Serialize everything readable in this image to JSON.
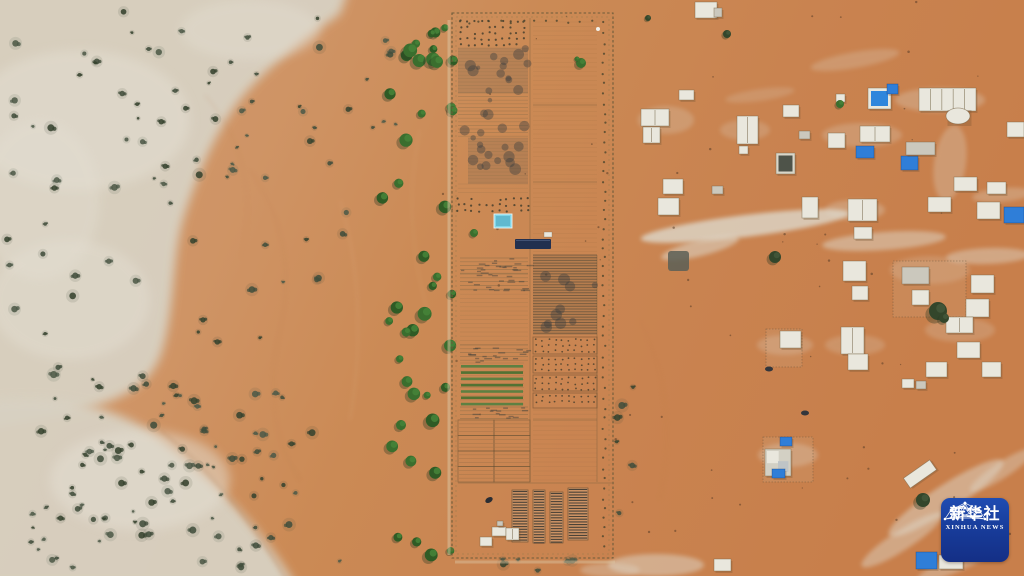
{
  "meta": {
    "description": "Aerial drone photograph of a desert landscape: a long fenced agricultural plot with cultivated fields in the center, pale sandy scrubland with scattered bushes on the left, a line of green trees beside the farm, and a scattered desert village of small white and blue-roofed buildings on orange sand to the right. A Xinhua News agency logo badge sits in the lower right corner."
  },
  "logo": {
    "cn": "新华社",
    "en": "XINHUA NEWS"
  },
  "palette": {
    "sand_left": "#d09a6e",
    "sand_mid": "#cb8a55",
    "sand_right": "#c87f4b",
    "sand_pale": "#d8d1c2",
    "sand_pale_light": "#e4dfd3",
    "sand_pale_green": "#cfd2bd",
    "scrub_green": "#4e5a48",
    "scrub_dark": "#37432f",
    "tree_green": "#3a6e2e",
    "tree_green_light": "#468238",
    "tree_shadow": "#2a3a22",
    "water_cyan": "#7fd6e9",
    "shade_navy": "#22304f",
    "building_white": "#e9e7dd",
    "building_gray": "#cbc8bd",
    "tarp_blue": "#2f7ed8",
    "dark_structure": "#5a5f56",
    "track_white": "#ded8ca",
    "fence_brown": "#6d5c3b",
    "logo_blue_top": "#1f4cb2",
    "logo_blue_bottom": "#142f86"
  },
  "scene": {
    "pale_areas": [
      {
        "d": "M -20 -20 L 352 -20 L 340 14 C 300 42 258 74 234 108 C 212 140 196 178 183 220 C 172 258 175 306 163 348 C 152 388 118 402 60 416 L -20 430 Z",
        "o": 0.95
      },
      {
        "d": "M -20 402 C 50 392 112 402 162 440 C 210 476 258 524 296 586 L -20 586 Z",
        "o": 0.95
      }
    ],
    "pale_patches": [
      [
        80,
        120,
        110,
        70,
        0.5
      ],
      [
        70,
        300,
        80,
        60,
        0.45
      ],
      [
        140,
        480,
        90,
        50,
        0.5
      ],
      [
        250,
        30,
        70,
        30,
        0.4
      ],
      [
        40,
        200,
        60,
        80,
        0.4
      ]
    ],
    "streaks": [
      [
        745,
        226,
        105,
        11,
        -7,
        0.8
      ],
      [
        700,
        248,
        40,
        8,
        -14,
        0.55
      ],
      [
        884,
        241,
        62,
        9,
        -4,
        0.5
      ],
      [
        950,
        163,
        16,
        38,
        8,
        0.3
      ],
      [
        988,
        256,
        42,
        8,
        -2,
        0.45
      ],
      [
        1002,
        195,
        30,
        7,
        -5,
        0.3
      ],
      [
        946,
        498,
        68,
        13,
        -33,
        0.5
      ],
      [
        902,
        540,
        48,
        10,
        -33,
        0.45
      ],
      [
        1002,
        470,
        38,
        8,
        -33,
        0.4
      ],
      [
        962,
        560,
        50,
        9,
        -25,
        0.4
      ],
      [
        656,
        565,
        48,
        11,
        0,
        0.5
      ],
      [
        610,
        570,
        30,
        7,
        0,
        0.35
      ],
      [
        855,
        60,
        45,
        8,
        -10,
        0.25
      ],
      [
        760,
        95,
        35,
        6,
        -8,
        0.2
      ],
      [
        666,
        120,
        28,
        14,
        0,
        0.25
      ],
      [
        745,
        130,
        25,
        10,
        0,
        0.22
      ],
      [
        862,
        135,
        40,
        12,
        0,
        0.25
      ],
      [
        940,
        100,
        45,
        12,
        0,
        0.3
      ],
      [
        855,
        210,
        30,
        10,
        0,
        0.3
      ],
      [
        960,
        330,
        35,
        12,
        0,
        0.22
      ],
      [
        855,
        345,
        30,
        10,
        0,
        0.22
      ],
      [
        785,
        345,
        28,
        10,
        0,
        0.25
      ],
      [
        788,
        455,
        30,
        12,
        0,
        0.3
      ],
      [
        930,
        270,
        40,
        14,
        0,
        0.2
      ]
    ],
    "dune_lines": [
      {
        "d": "M 160 430 C 210 470 252 520 290 586",
        "c": "#a4693c",
        "o": 0.3,
        "w": 2
      },
      {
        "d": "M 250 170 Q 300 240 280 330 T 300 480",
        "c": "#b5784a",
        "o": 0.2,
        "w": 1.5
      },
      {
        "d": "M 205 95 Q 262 160 242 258",
        "c": "#b5784a",
        "o": 0.18,
        "w": 1.3
      },
      {
        "d": "M 340 200 Q 370 300 350 420",
        "c": "#e2b489",
        "o": 0.3,
        "w": 1.3
      },
      {
        "d": "M 420 130 Q 400 220 430 320",
        "c": "#e2b489",
        "o": 0.25,
        "w": 1.2
      },
      {
        "d": "M 640 320 Q 680 400 660 500",
        "c": "#c07b49",
        "o": 0.15,
        "w": 2
      }
    ],
    "vegetation_regions": [
      [
        5,
        8,
        330,
        165,
        42,
        "scrub",
        11
      ],
      [
        0,
        170,
        175,
        230,
        26,
        "scrub",
        23
      ],
      [
        8,
        392,
        295,
        178,
        52,
        "scrub",
        37
      ],
      [
        60,
        415,
        200,
        120,
        30,
        "scrub",
        41
      ],
      [
        185,
        140,
        165,
        430,
        24,
        "scrub",
        53
      ],
      [
        330,
        20,
        70,
        110,
        8,
        "scrub",
        61
      ],
      [
        382,
        55,
        72,
        515,
        34,
        "tree",
        71
      ],
      [
        390,
        15,
        62,
        50,
        9,
        "tree",
        83
      ],
      [
        470,
        558,
        120,
        16,
        6,
        "scrub",
        97
      ],
      [
        615,
        300,
        25,
        240,
        6,
        "scrub",
        101
      ],
      [
        620,
        0,
        400,
        540,
        45,
        "speck",
        103
      ],
      [
        440,
        0,
        180,
        570,
        20,
        "speck",
        109
      ]
    ],
    "village_trees": [
      [
        775,
        257,
        6,
        "dark"
      ],
      [
        938,
        311,
        9,
        "dark"
      ],
      [
        944,
        318,
        5,
        "dark"
      ],
      [
        840,
        104,
        4,
        "green"
      ],
      [
        727,
        34,
        4,
        "dark"
      ],
      [
        923,
        500,
        7,
        "dark"
      ],
      [
        648,
        18,
        3,
        "dark"
      ],
      [
        581,
        63,
        5,
        "green"
      ],
      [
        577,
        59,
        2.5,
        "green"
      ],
      [
        474,
        233,
        4,
        "green"
      ]
    ],
    "farm": {
      "fence_outer": [
        452,
        13,
        161,
        545
      ],
      "fence_inner": [
        456,
        17,
        153,
        537
      ],
      "lanes": [
        [
          530,
          18,
          530,
          482
        ],
        [
          458,
          483,
          612,
          483
        ],
        [
          533,
          420,
          597,
          420
        ],
        [
          597,
          255,
          597,
          482
        ],
        [
          533,
          105,
          597,
          105
        ],
        [
          533,
          182,
          597,
          182
        ]
      ],
      "track_left": [
        449,
        20,
        449,
        555
      ],
      "track_bottom": [
        455,
        562,
        615,
        562
      ],
      "blocks": [
        [
          458,
          18,
          70,
          30,
          "orchard"
        ],
        [
          458,
          48,
          70,
          45,
          "darkpatch"
        ],
        [
          458,
          93,
          70,
          45,
          "rowspeckle"
        ],
        [
          468,
          138,
          60,
          46,
          "darkpatch"
        ],
        [
          458,
          184,
          70,
          12,
          "rowsfaint"
        ],
        [
          455,
          196,
          80,
          18,
          "orchard"
        ],
        [
          460,
          258,
          68,
          16,
          "rows"
        ],
        [
          460,
          274,
          68,
          16,
          "rows"
        ],
        [
          460,
          290,
          68,
          55,
          "rowsfaint"
        ],
        [
          460,
          345,
          68,
          17,
          "rows"
        ],
        [
          460,
          363,
          64,
          44,
          "greenrows"
        ],
        [
          460,
          407,
          68,
          13,
          "rows"
        ],
        [
          458,
          420,
          72,
          62,
          "grid"
        ],
        [
          533,
          20,
          64,
          85,
          "furrows"
        ],
        [
          533,
          105,
          64,
          75,
          "furrows"
        ],
        [
          533,
          182,
          64,
          70,
          "furrows"
        ],
        [
          533,
          255,
          64,
          80,
          "rowsdark"
        ],
        [
          533,
          337,
          64,
          17,
          "dots"
        ],
        [
          533,
          356,
          64,
          17,
          "dots"
        ],
        [
          533,
          375,
          64,
          16,
          "dots"
        ],
        [
          533,
          393,
          64,
          15,
          "dots"
        ],
        [
          533,
          410,
          64,
          12,
          "rowsfaint"
        ],
        [
          533,
          424,
          64,
          58,
          "furrows"
        ]
      ],
      "nursery_beds": [
        [
          512,
          490,
          16,
          52
        ],
        [
          533,
          490,
          12,
          53
        ],
        [
          550,
          492,
          13,
          51
        ],
        [
          568,
          488,
          20,
          52
        ]
      ],
      "pond": [
        494,
        214,
        18,
        14
      ],
      "shade_structure": [
        515,
        239,
        36,
        10
      ],
      "white_hut": [
        544,
        232,
        8,
        5
      ],
      "white_dot": [
        598,
        29
      ],
      "car": [
        489,
        500
      ],
      "buildings": [
        [
          492,
          527,
          14,
          9,
          "w"
        ],
        [
          506,
          528,
          13,
          12,
          "w2"
        ],
        [
          480,
          537,
          12,
          9,
          "w"
        ],
        [
          497,
          521,
          6,
          5,
          "g"
        ]
      ],
      "fence_dot_cols": [
        [
          604,
          22,
          548
        ]
      ],
      "fence_dot_rows": [
        [
          22,
          460,
          600
        ]
      ]
    },
    "village": {
      "compound_fences": [
        [
          893,
          261,
          73,
          56
        ],
        [
          766,
          329,
          36,
          38
        ],
        [
          763,
          437,
          50,
          45
        ]
      ],
      "buildings": [
        [
          695,
          2,
          22,
          16,
          "w"
        ],
        [
          714,
          8,
          8,
          9,
          "g"
        ],
        [
          679,
          90,
          15,
          10,
          "w"
        ],
        [
          641,
          109,
          28,
          17,
          "w2"
        ],
        [
          643,
          127,
          17,
          16,
          "w2"
        ],
        [
          737,
          116,
          21,
          28,
          "w2"
        ],
        [
          739,
          146,
          9,
          8,
          "w"
        ],
        [
          783,
          105,
          16,
          12,
          "w"
        ],
        [
          799,
          131,
          11,
          8,
          "g"
        ],
        [
          776,
          153,
          19,
          21,
          "dc"
        ],
        [
          663,
          179,
          20,
          15,
          "w"
        ],
        [
          712,
          186,
          11,
          8,
          "g"
        ],
        [
          658,
          198,
          21,
          17,
          "w"
        ],
        [
          802,
          197,
          16,
          21,
          "w"
        ],
        [
          668,
          251,
          21,
          20,
          "d"
        ],
        [
          836,
          94,
          9,
          8,
          "w"
        ],
        [
          868,
          88,
          23,
          21,
          "br"
        ],
        [
          887,
          84,
          11,
          10,
          "b"
        ],
        [
          919,
          88,
          57,
          23,
          "wl"
        ],
        [
          946,
          108,
          24,
          16,
          "wr"
        ],
        [
          860,
          126,
          30,
          16,
          "w2"
        ],
        [
          828,
          133,
          17,
          15,
          "w"
        ],
        [
          856,
          146,
          18,
          12,
          "b"
        ],
        [
          901,
          156,
          17,
          14,
          "b"
        ],
        [
          906,
          142,
          29,
          13,
          "g"
        ],
        [
          1007,
          122,
          17,
          15,
          "w"
        ],
        [
          954,
          177,
          23,
          14,
          "w"
        ],
        [
          987,
          182,
          19,
          12,
          "w"
        ],
        [
          848,
          199,
          29,
          22,
          "w2"
        ],
        [
          928,
          197,
          23,
          15,
          "w"
        ],
        [
          977,
          202,
          23,
          17,
          "w"
        ],
        [
          1004,
          207,
          20,
          16,
          "b"
        ],
        [
          854,
          227,
          18,
          12,
          "w"
        ],
        [
          843,
          261,
          23,
          20,
          "w"
        ],
        [
          852,
          286,
          16,
          14,
          "w"
        ],
        [
          902,
          267,
          27,
          17,
          "g"
        ],
        [
          912,
          290,
          17,
          15,
          "w"
        ],
        [
          971,
          275,
          23,
          18,
          "w"
        ],
        [
          966,
          299,
          23,
          18,
          "w"
        ],
        [
          841,
          327,
          23,
          27,
          "w2"
        ],
        [
          848,
          354,
          20,
          16,
          "w"
        ],
        [
          946,
          317,
          27,
          16,
          "w2"
        ],
        [
          957,
          342,
          23,
          16,
          "w"
        ],
        [
          926,
          362,
          21,
          15,
          "w"
        ],
        [
          982,
          362,
          19,
          15,
          "w"
        ],
        [
          902,
          379,
          12,
          9,
          "w"
        ],
        [
          916,
          381,
          10,
          8,
          "g"
        ],
        [
          780,
          331,
          21,
          17,
          "w"
        ],
        [
          780,
          437,
          12,
          9,
          "b"
        ],
        [
          765,
          449,
          26,
          27,
          "k"
        ],
        [
          772,
          469,
          13,
          9,
          "b"
        ],
        [
          916,
          552,
          21,
          17,
          "b"
        ],
        [
          939,
          555,
          24,
          14,
          "w"
        ],
        [
          904,
          468,
          32,
          12,
          "w",
          -35
        ],
        [
          714,
          559,
          17,
          12,
          "w"
        ]
      ],
      "cars": [
        [
          769,
          369
        ],
        [
          805,
          413
        ]
      ]
    }
  }
}
